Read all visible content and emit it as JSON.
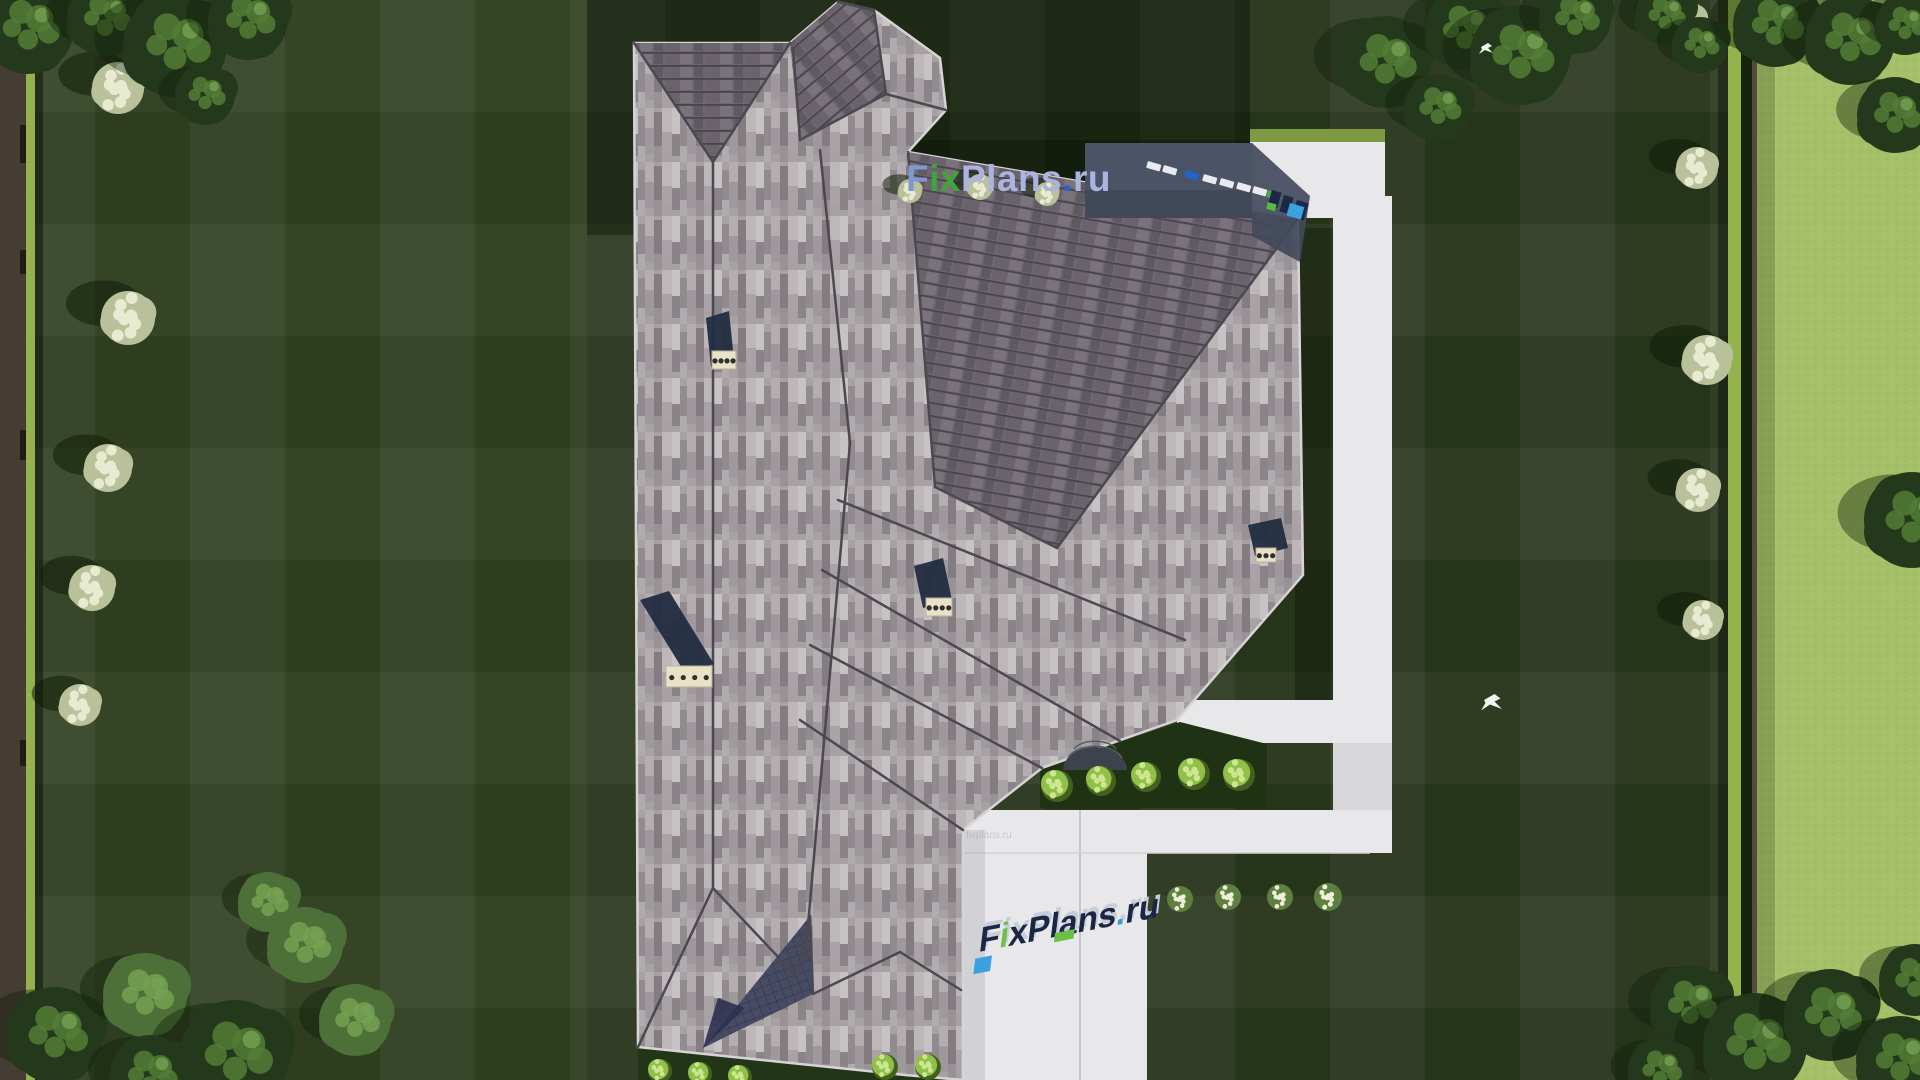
{
  "page": {
    "title": "Aerial top-down 3D render of a house roof plan with landscaped yard",
    "source_brand": "FixPlans.ru"
  },
  "watermarks": {
    "main": {
      "text": "FixPlans.ru",
      "segments": [
        {
          "t": "F",
          "c": "#8097d2"
        },
        {
          "t": "ix",
          "c": "#3fa53c"
        },
        {
          "t": "Plans",
          "c": "#aab4de"
        },
        {
          "t": ".",
          "c": "#2e5ed0"
        },
        {
          "t": "ru",
          "c": "#aab4de"
        }
      ]
    },
    "ground": {
      "text": "FixPlans.ru",
      "segments": [
        {
          "t": "F",
          "c": "#1b2544"
        },
        {
          "t": "i",
          "c": "#6fc04a"
        },
        {
          "t": "x",
          "c": "#1b2544"
        },
        {
          "t": "Plans",
          "c": "#1b2544"
        },
        {
          "t": ".",
          "c": "#2ea0d8"
        },
        {
          "t": "ru",
          "c": "#1b2544"
        }
      ]
    },
    "faint": {
      "text": "fixplans.ru"
    }
  },
  "palette": {
    "lawn_dark": "#263419",
    "lawn_shadow": "#101d08",
    "field_light": "#a6c06a",
    "hedge_bright": "#93b24c",
    "concrete": "#e8e8ea",
    "roof_light": "#a7a1a4",
    "roof_dark": "#6f6870",
    "glass_shadow": "#4b5366",
    "canopy_dark": "#24391b",
    "canopy_mid": "#4c7038",
    "canopy_highlight": "#76a152",
    "shrub_bright": "#8fc04a",
    "flower_bush_cream": "#e9ead2",
    "chimney_navy": "#222c40",
    "chimney_cap": "#e9e2c6",
    "skylight_white": "#e8eaf0",
    "skylight_blue": "#2563c4",
    "skylight_green": "#3fae3f",
    "cube_cyan": "#38a3dd",
    "cube_green": "#55bb44"
  },
  "scene": {
    "trees": [
      {
        "x": 28,
        "y": 28,
        "r": 46,
        "tone": "dark"
      },
      {
        "x": 105,
        "y": 18,
        "r": 38,
        "tone": "dark"
      },
      {
        "x": 175,
        "y": 45,
        "r": 52,
        "tone": "dark"
      },
      {
        "x": 248,
        "y": 20,
        "r": 40,
        "tone": "dark"
      },
      {
        "x": 205,
        "y": 95,
        "r": 30,
        "tone": "dark"
      },
      {
        "x": 1385,
        "y": 62,
        "r": 46,
        "tone": "dark"
      },
      {
        "x": 1438,
        "y": 108,
        "r": 34,
        "tone": "dark"
      },
      {
        "x": 1465,
        "y": 30,
        "r": 40,
        "tone": "dark"
      },
      {
        "x": 1520,
        "y": 55,
        "r": 50,
        "tone": "dark"
      },
      {
        "x": 1575,
        "y": 18,
        "r": 36,
        "tone": "dark"
      },
      {
        "x": 1665,
        "y": 15,
        "r": 30,
        "tone": "dark"
      },
      {
        "x": 1700,
        "y": 45,
        "r": 28,
        "tone": "dark"
      },
      {
        "x": 1775,
        "y": 25,
        "r": 42,
        "tone": "dark"
      },
      {
        "x": 1850,
        "y": 40,
        "r": 45,
        "tone": "dark"
      },
      {
        "x": 1895,
        "y": 115,
        "r": 38,
        "tone": "dark"
      },
      {
        "x": 1905,
        "y": 25,
        "r": 30,
        "tone": "dark"
      },
      {
        "x": 1912,
        "y": 520,
        "r": 48,
        "tone": "dark"
      },
      {
        "x": 1690,
        "y": 1005,
        "r": 40,
        "tone": "dark"
      },
      {
        "x": 1755,
        "y": 1045,
        "r": 52,
        "tone": "dark"
      },
      {
        "x": 1830,
        "y": 1015,
        "r": 46,
        "tone": "dark"
      },
      {
        "x": 1900,
        "y": 1060,
        "r": 44,
        "tone": "dark"
      },
      {
        "x": 1660,
        "y": 1070,
        "r": 32,
        "tone": "dark"
      },
      {
        "x": 1915,
        "y": 980,
        "r": 36,
        "tone": "dark"
      },
      {
        "x": 55,
        "y": 1035,
        "r": 48,
        "tone": "dark"
      },
      {
        "x": 145,
        "y": 995,
        "r": 42,
        "tone": "mid"
      },
      {
        "x": 235,
        "y": 1055,
        "r": 55,
        "tone": "dark"
      },
      {
        "x": 305,
        "y": 945,
        "r": 38,
        "tone": "mid"
      },
      {
        "x": 355,
        "y": 1020,
        "r": 36,
        "tone": "mid"
      },
      {
        "x": 150,
        "y": 1075,
        "r": 40,
        "tone": "dark"
      },
      {
        "x": 268,
        "y": 902,
        "r": 30,
        "tone": "mid"
      }
    ],
    "white_bushes": [
      {
        "x": 118,
        "y": 88,
        "r": 26
      },
      {
        "x": 128,
        "y": 318,
        "r": 27
      },
      {
        "x": 108,
        "y": 468,
        "r": 24
      },
      {
        "x": 92,
        "y": 588,
        "r": 23
      },
      {
        "x": 80,
        "y": 705,
        "r": 21
      },
      {
        "x": 1685,
        "y": 22,
        "r": 22
      },
      {
        "x": 1697,
        "y": 168,
        "r": 21
      },
      {
        "x": 1707,
        "y": 360,
        "r": 25
      },
      {
        "x": 1698,
        "y": 490,
        "r": 22
      },
      {
        "x": 1703,
        "y": 620,
        "r": 20
      },
      {
        "x": 910,
        "y": 191,
        "r": 12
      },
      {
        "x": 980,
        "y": 187,
        "r": 13
      },
      {
        "x": 1047,
        "y": 194,
        "r": 12
      }
    ],
    "green_shrubs": [
      {
        "x": 1057,
        "y": 786,
        "r": 16
      },
      {
        "x": 1101,
        "y": 781,
        "r": 15
      },
      {
        "x": 1146,
        "y": 777,
        "r": 15
      },
      {
        "x": 1194,
        "y": 774,
        "r": 16
      },
      {
        "x": 1239,
        "y": 775,
        "r": 16
      },
      {
        "x": 660,
        "y": 1071,
        "r": 12
      },
      {
        "x": 700,
        "y": 1074,
        "r": 12
      },
      {
        "x": 740,
        "y": 1077,
        "r": 12
      },
      {
        "x": 885,
        "y": 1067,
        "r": 13
      },
      {
        "x": 928,
        "y": 1067,
        "r": 13
      }
    ],
    "flower_bushes": [
      {
        "x": 1180,
        "y": 899,
        "r": 13
      },
      {
        "x": 1228,
        "y": 897,
        "r": 13
      },
      {
        "x": 1280,
        "y": 897,
        "r": 13
      },
      {
        "x": 1328,
        "y": 897,
        "r": 14
      }
    ],
    "chimneys": [
      {
        "panel": [
          [
            706,
            318
          ],
          [
            729,
            311
          ],
          [
            734,
            360
          ],
          [
            711,
            367
          ]
        ],
        "cap": {
          "x": 712,
          "y": 351,
          "w": 24,
          "h": 18,
          "dots": 4
        }
      },
      {
        "panel": [
          [
            640,
            600
          ],
          [
            669,
            591
          ],
          [
            714,
            664
          ],
          [
            685,
            673
          ]
        ],
        "cap": {
          "x": 666,
          "y": 666,
          "w": 46,
          "h": 21,
          "dots": 4
        }
      },
      {
        "panel": [
          [
            914,
            566
          ],
          [
            943,
            558
          ],
          [
            952,
            600
          ],
          [
            923,
            608
          ]
        ],
        "cap": {
          "x": 926,
          "y": 598,
          "w": 26,
          "h": 18,
          "dots": 4
        }
      },
      {
        "panel": [
          [
            1248,
            525
          ],
          [
            1281,
            518
          ],
          [
            1288,
            548
          ],
          [
            1255,
            556
          ]
        ],
        "cap": {
          "x": 1256,
          "y": 548,
          "w": 20,
          "h": 14,
          "dots": 3
        }
      }
    ],
    "skylights": [
      {
        "x": 1148,
        "y": 161,
        "c": "white"
      },
      {
        "x": 1164,
        "y": 165,
        "c": "white"
      },
      {
        "x": 1186,
        "y": 170,
        "c": "blue"
      },
      {
        "x": 1204,
        "y": 174,
        "c": "white"
      },
      {
        "x": 1221,
        "y": 178,
        "c": "white"
      },
      {
        "x": 1238,
        "y": 182,
        "c": "white"
      },
      {
        "x": 1254,
        "y": 186,
        "c": "white"
      },
      {
        "x": 1268,
        "y": 190,
        "c": "green"
      }
    ],
    "letter_blocks": [
      {
        "x": 1272,
        "y": 190,
        "w": 10,
        "h": 16,
        "c": "navy"
      },
      {
        "x": 1284,
        "y": 195,
        "w": 10,
        "h": 17,
        "c": "navy"
      },
      {
        "x": 1297,
        "y": 200,
        "w": 12,
        "h": 18,
        "c": "navy"
      },
      {
        "x": 1290,
        "y": 203,
        "w": 15,
        "h": 13,
        "c": "cyan"
      },
      {
        "x": 1268,
        "y": 202,
        "w": 9,
        "h": 7,
        "c": "green"
      }
    ],
    "birds": [
      {
        "x": 1481,
        "y": 47,
        "s": 1.0
      },
      {
        "x": 1484,
        "y": 700,
        "s": 1.5
      }
    ]
  }
}
